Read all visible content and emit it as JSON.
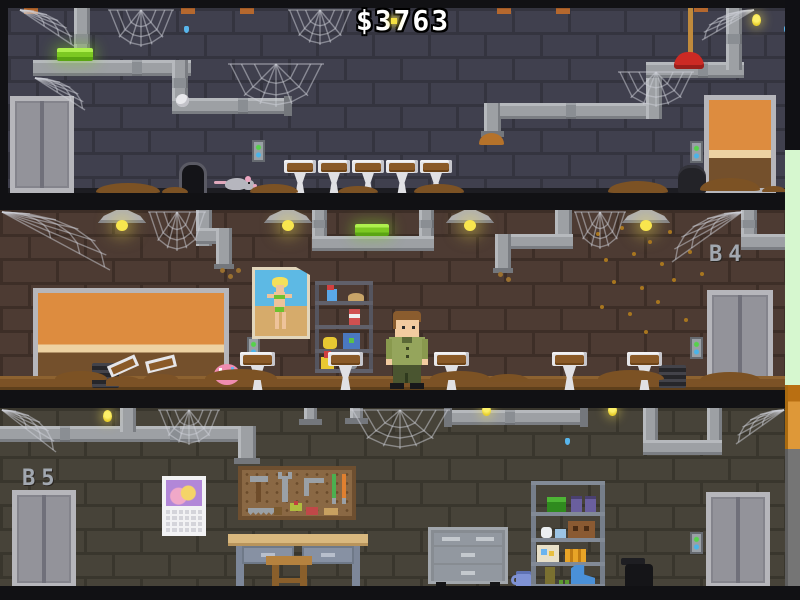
{
  "hud": {
    "money_display": "$3763"
  },
  "labels": {
    "floor_middle": "B4",
    "floor_bottom": "B5"
  },
  "scene": {
    "floors": [
      {
        "name": "top-floor",
        "wall_color": "#40404e"
      },
      {
        "name": "middle-floor-b4",
        "wall_color": "#4d3b33"
      },
      {
        "name": "bottom-floor-b5",
        "wall_color": "#474339"
      }
    ],
    "objects": [
      "elevator",
      "wooden-door",
      "light-switch",
      "ceiling-lamp",
      "green-tube-light",
      "pipe",
      "cobweb",
      "firefly",
      "water-drip",
      "sink-with-dirt",
      "tipped-sink",
      "dirt-pile",
      "mouse-hole",
      "rat",
      "egg-sac",
      "bucket",
      "plunger",
      "donut",
      "pinup-poster",
      "supply-shelf",
      "janitor-character",
      "floor-vent",
      "fly-swarm",
      "calendar",
      "pegboard-tools",
      "workbench",
      "stool",
      "rolling-tool-cabinet",
      "storage-shelf",
      "mug",
      "trash-can"
    ]
  },
  "colors": {
    "money_text": "#ffffff",
    "outline": "#000000",
    "pipe": "#9da0a4",
    "dirt": "#7c5226",
    "accent_green": "#7cc922",
    "firefly": "#f4e042",
    "door_orange": "#dd8c3f",
    "elevator_gray": "#93939a",
    "button_green": "#55d24a",
    "button_blue": "#49b4ea",
    "side_strip_green": "#d6f7cf",
    "side_strip_orange": "#de9838",
    "side_strip_gray": "#757575",
    "web": "#cfd2da",
    "poster_sky": "#5db9e4",
    "player_uniform": "#95a55c"
  }
}
